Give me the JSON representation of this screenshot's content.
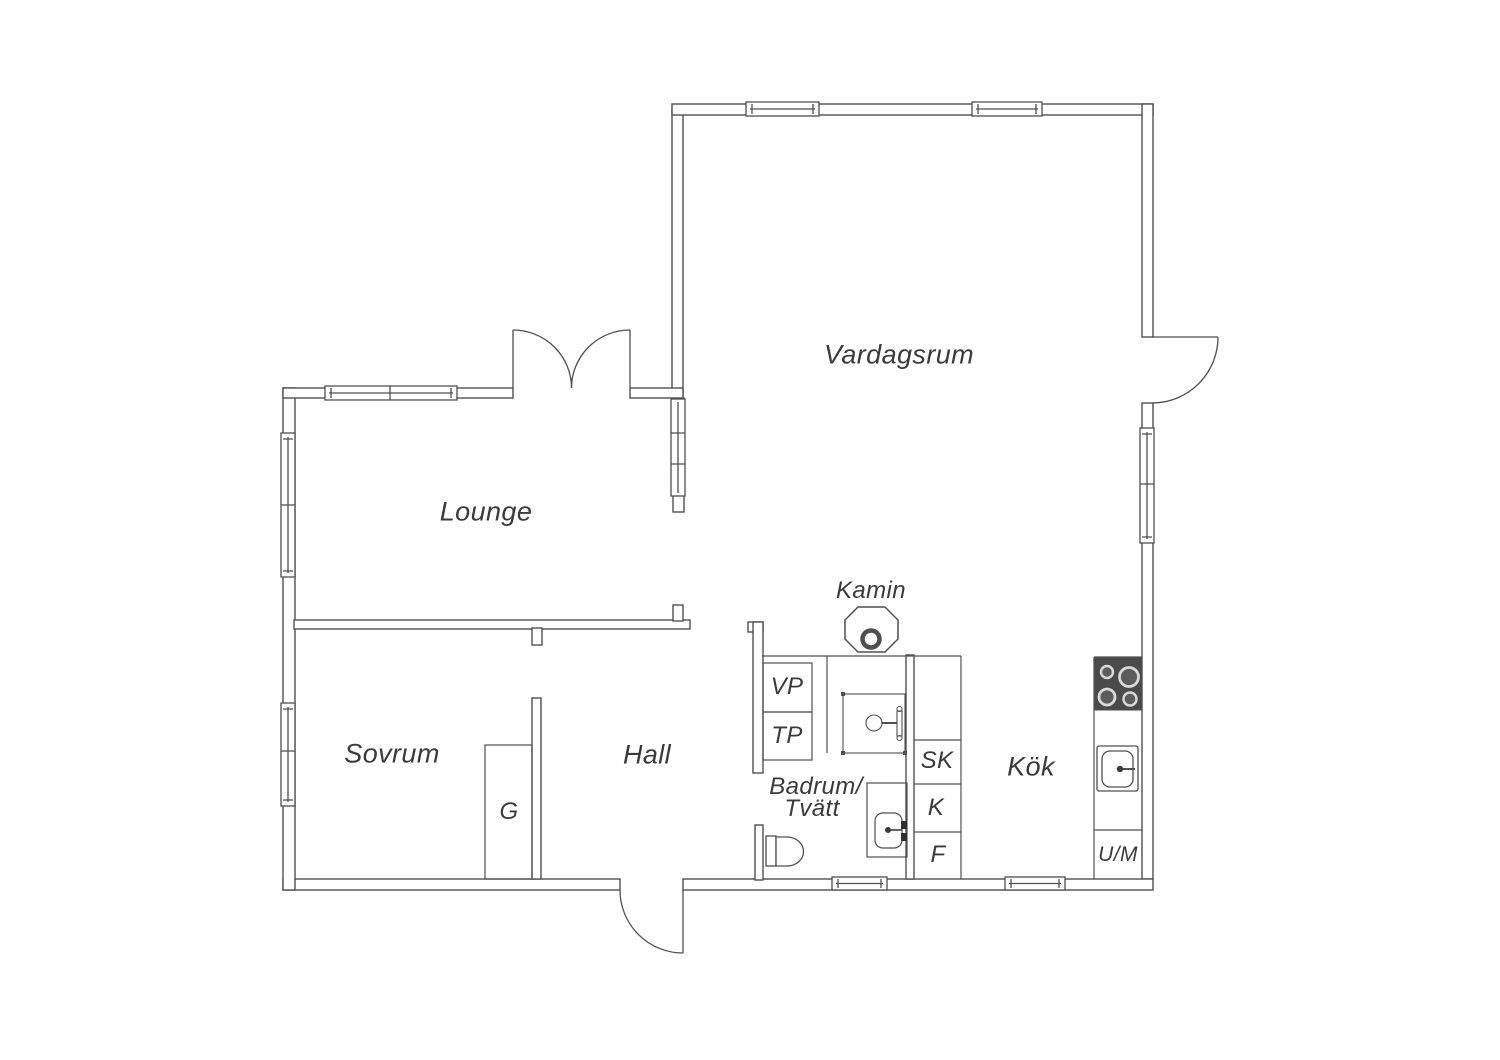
{
  "colors": {
    "wall_line": "#4f4f4f",
    "text": "#3a3a3a",
    "stove_panel": "#4a4a4a",
    "background": "#ffffff"
  },
  "rooms": {
    "vardagsrum": "Vardagsrum",
    "lounge": "Lounge",
    "sovrum": "Sovrum",
    "hall": "Hall",
    "kok": "Kök",
    "badrum_line1": "Badrum/",
    "badrum_line2": "Tvätt"
  },
  "fixtures": {
    "kamin": "Kamin",
    "vp": "VP",
    "tp": "TP",
    "sk": "SK",
    "k": "K",
    "f": "F",
    "g": "G",
    "um": "U/M"
  }
}
